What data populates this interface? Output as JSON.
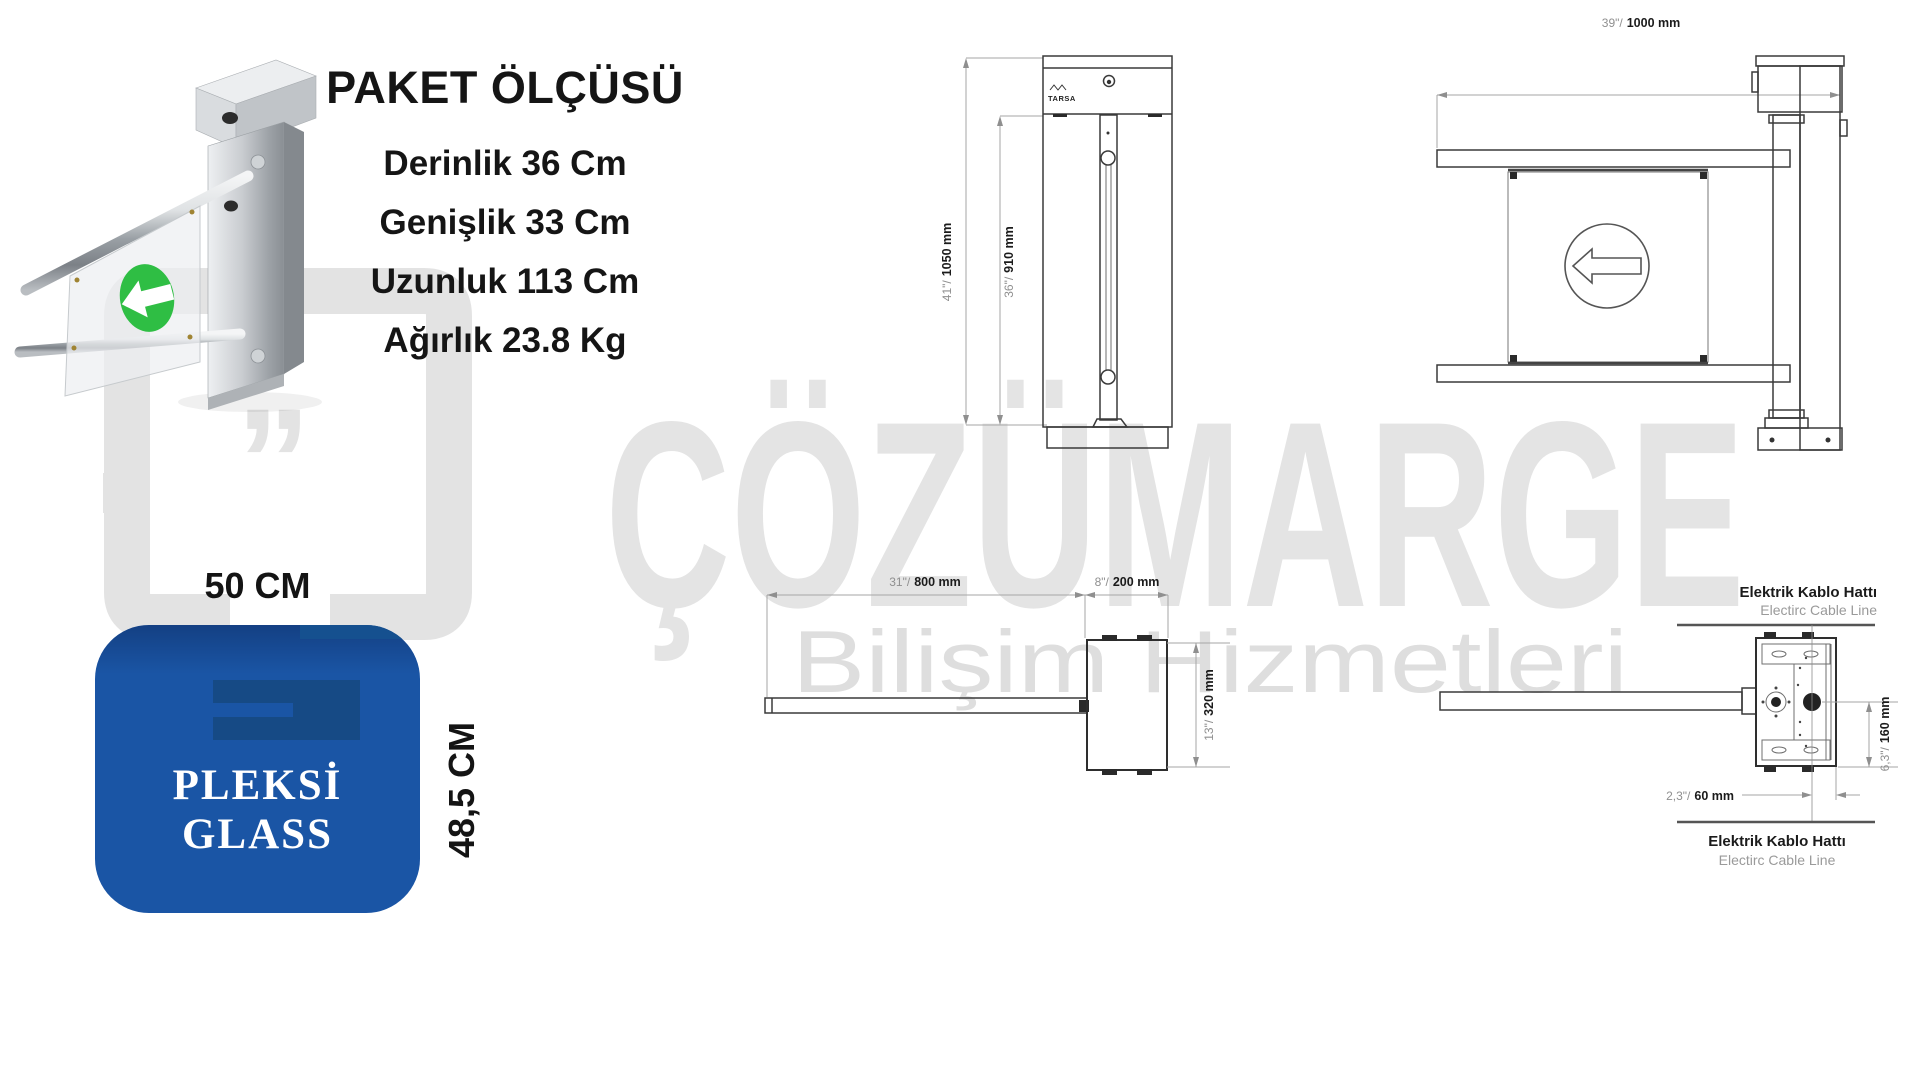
{
  "package": {
    "title": "PAKET ÖLÇÜSÜ",
    "lines": [
      "Derinlik 36 Cm",
      "Genişlik 33 Cm",
      "Uzunluk 113 Cm",
      "Ağırlık 23.8 Kg"
    ]
  },
  "pleksi": {
    "width_label": "50 CM",
    "height_label": "48,5 CM",
    "panel_label": "PLEKSİ GLASS",
    "panel_color": "#1a55a5"
  },
  "watermark": {
    "brand": "ÇÖZÜMARGE",
    "subtitle": "Bilişim Hizmetleri",
    "quote": "”"
  },
  "drawing": {
    "brand_logo": "TARSA",
    "cable_line_tr": "Elektrik Kablo Hattı",
    "cable_line_en": "Electirc Cable Line"
  },
  "dims": {
    "front_height": {
      "inch": "41\"/",
      "mm": "1050 mm"
    },
    "front_panel": {
      "inch": "36\"/",
      "mm": "910 mm"
    },
    "top_width": {
      "inch": "39\"/",
      "mm": "1000 mm"
    },
    "arm_length": {
      "inch": "31\"/",
      "mm": "800 mm"
    },
    "cabinet_width": {
      "inch": "8\"/",
      "mm": "200 mm"
    },
    "cabinet_depth": {
      "inch": "13\"/",
      "mm": "320 mm"
    },
    "cable_vertical": {
      "inch": "6,3\"/",
      "mm": "160 mm"
    },
    "cable_horizontal": {
      "inch": "2,3\"/",
      "mm": "60 mm"
    }
  },
  "colors": {
    "accent_blue": "#1a55a5",
    "arrow_green": "#2fbe44",
    "watermark_gray": "#e3e3e3"
  }
}
